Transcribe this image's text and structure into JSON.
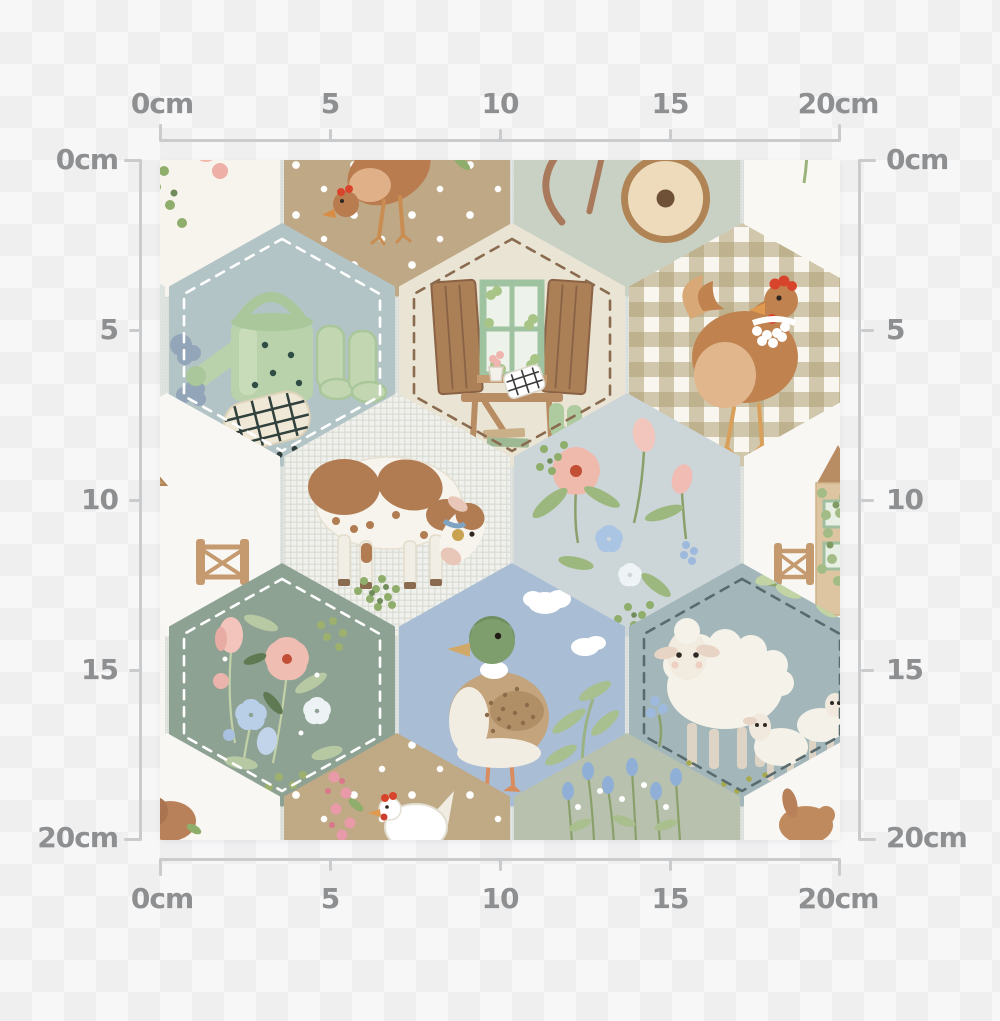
{
  "rulers": {
    "labels": [
      "0cm",
      "5",
      "10",
      "15",
      "20cm"
    ],
    "unit": "cm",
    "max_value_cm": 20,
    "line_color": "#c9cbcd",
    "label_color": "#8d8f91"
  },
  "swatch": {
    "description": "watercolor farmhouse animals hexagon patchwork fabric swatch",
    "width_cm": 20,
    "height_cm": 20,
    "base_color": "#d9ddd9",
    "tiles": [
      {
        "motif": "cowpatch",
        "fill": "#f7f4ee",
        "x": 7,
        "y": 15
      },
      {
        "motif": "henTan",
        "fill": "#bfa886",
        "x": 237,
        "y": 15,
        "dots": true
      },
      {
        "motif": "wheelbarrow",
        "fill": "#c9d1c5",
        "x": 467,
        "y": 15
      },
      {
        "motif": "flowersWhite",
        "fill": "#faf8f3",
        "x": 697,
        "y": 15
      },
      {
        "motif": "plain",
        "fill": "#dfe3df",
        "x": -108,
        "y": 185
      },
      {
        "motif": "watering",
        "fill": "#b3c4c6",
        "x": 122,
        "y": 185,
        "stitch": "#ffffff"
      },
      {
        "motif": "window",
        "fill": "#e9e4d3",
        "x": 352,
        "y": 185,
        "stitch": "#8a6b4f"
      },
      {
        "motif": "ginghamHen",
        "fill": "gingham",
        "x": 582,
        "y": 185
      },
      {
        "motif": "plain",
        "fill": "#f8f7f2",
        "x": 812,
        "y": 185
      },
      {
        "motif": "houseLeft",
        "fill": "#f8f7f3",
        "x": 7,
        "y": 355
      },
      {
        "motif": "cowGrazing",
        "fill": "#f0f1ec",
        "x": 237,
        "y": 355,
        "weave": true
      },
      {
        "motif": "meadow",
        "fill": "#ccd5d7",
        "x": 467,
        "y": 355
      },
      {
        "motif": "houseRight",
        "fill": "#f8f7f3",
        "x": 697,
        "y": 355
      },
      {
        "motif": "plain",
        "fill": "#f6f5f1",
        "x": -108,
        "y": 525
      },
      {
        "motif": "greenFloral",
        "fill": "#8ea294",
        "x": 122,
        "y": 525,
        "stitch": "#ffffff"
      },
      {
        "motif": "duck",
        "fill": "#a9bdd5",
        "x": 352,
        "y": 525
      },
      {
        "motif": "sheep",
        "fill": "#a3b7ba",
        "x": 582,
        "y": 525,
        "stitch": "#5a6b6e"
      },
      {
        "motif": "plain",
        "fill": "#f6f5f1",
        "x": 812,
        "y": 525
      },
      {
        "motif": "animalCorner",
        "fill": "#f8f7f3",
        "x": 7,
        "y": 695
      },
      {
        "motif": "henWhite",
        "fill": "#c0a985",
        "x": 237,
        "y": 695,
        "dots": true
      },
      {
        "motif": "wildflowers",
        "fill": "#b8c1ae",
        "x": 467,
        "y": 695
      },
      {
        "motif": "animalCorner2",
        "fill": "#f8f7f3",
        "x": 697,
        "y": 695
      }
    ]
  }
}
